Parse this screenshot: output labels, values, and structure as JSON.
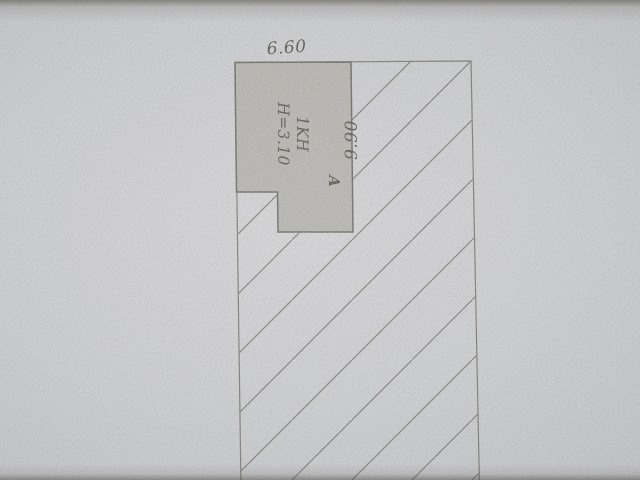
{
  "drawing": {
    "type": "cadastral site-plan sketch (photo of paper document)",
    "dimension_top": "6.60",
    "dimension_side": "9.90",
    "building_label": "1KH",
    "building_height": "H=3.10",
    "section_label": "A"
  },
  "colors": {
    "paper_light": "#d7d7d9",
    "paper_mid": "#cdced1",
    "paper_dark": "#b4b5b9",
    "building_fill": "#b3b2ac",
    "building_stroke": "#5f5d55",
    "parcel_stroke": "#6f6e66",
    "hatch_line": "#74736c",
    "text": "#49463e"
  }
}
